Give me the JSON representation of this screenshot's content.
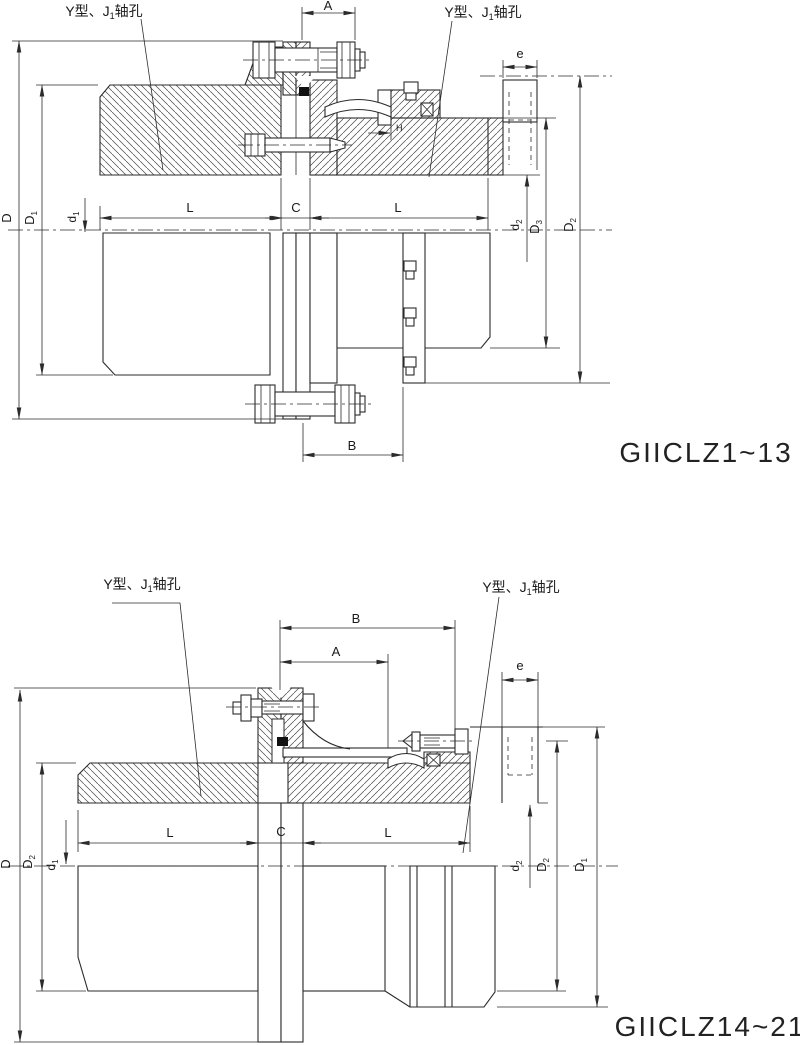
{
  "drawing": {
    "background": "#ffffff",
    "line_color": "#2b2b2b",
    "figures": [
      {
        "id": "top",
        "title": "GIICLZ1~13",
        "shaft_label_left": {
          "prefix": "Y型、J",
          "sub": "1",
          "suffix": "轴孔"
        },
        "shaft_label_right": {
          "prefix": "Y型、J",
          "sub": "1",
          "suffix": "轴孔"
        },
        "dims": {
          "A": {
            "base": "A"
          },
          "B": {
            "base": "B"
          },
          "C": {
            "base": "C"
          },
          "L1": {
            "base": "L"
          },
          "L2": {
            "base": "L"
          },
          "e": {
            "base": "e"
          },
          "H": {
            "base": "H"
          },
          "D": {
            "base": "D"
          },
          "D1": {
            "base": "D",
            "sub": "1"
          },
          "d1": {
            "base": "d",
            "sub": "1"
          },
          "d2": {
            "base": "d",
            "sub": "2"
          },
          "D3": {
            "base": "D",
            "sub": "3"
          },
          "D2": {
            "base": "D",
            "sub": "2"
          }
        }
      },
      {
        "id": "bottom",
        "title": "GIICLZ14~21",
        "shaft_label_left": {
          "prefix": "Y型、J",
          "sub": "1",
          "suffix": "轴孔"
        },
        "shaft_label_right": {
          "prefix": "Y型、J",
          "sub": "1",
          "suffix": "轴孔"
        },
        "dims": {
          "A": {
            "base": "A"
          },
          "B": {
            "base": "B"
          },
          "C": {
            "base": "C"
          },
          "L1": {
            "base": "L"
          },
          "L2": {
            "base": "L"
          },
          "e": {
            "base": "e"
          },
          "D": {
            "base": "D"
          },
          "D2_left": {
            "base": "D",
            "sub": "2"
          },
          "d1": {
            "base": "d",
            "sub": "1"
          },
          "d2": {
            "base": "d",
            "sub": "2"
          },
          "D2_right": {
            "base": "D",
            "sub": "2"
          },
          "D1": {
            "base": "D",
            "sub": "1"
          }
        }
      }
    ]
  }
}
